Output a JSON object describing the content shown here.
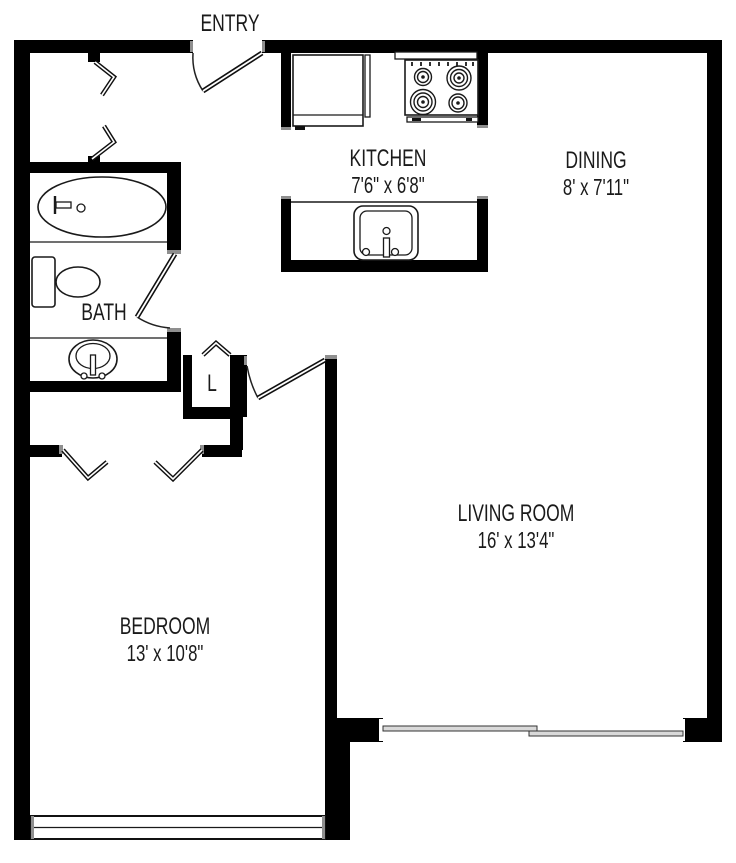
{
  "floor_plan": {
    "rooms": {
      "entry": {
        "label": "ENTRY"
      },
      "kitchen": {
        "label": "KITCHEN",
        "dimensions": "7'6\" x 6'8\""
      },
      "dining": {
        "label": "DINING",
        "dimensions": "8' x 7'11\""
      },
      "bath": {
        "label": "BATH"
      },
      "linen_closet": {
        "label": "L"
      },
      "living_room": {
        "label": "LIVING ROOM",
        "dimensions": "16' x 13'4\""
      },
      "bedroom": {
        "label": "BEDROOM",
        "dimensions": "13' x 10'8\""
      }
    },
    "colors": {
      "wall": "#000000",
      "line": "#1a1a1a",
      "text": "#1a1a1a",
      "background": "#ffffff"
    }
  }
}
